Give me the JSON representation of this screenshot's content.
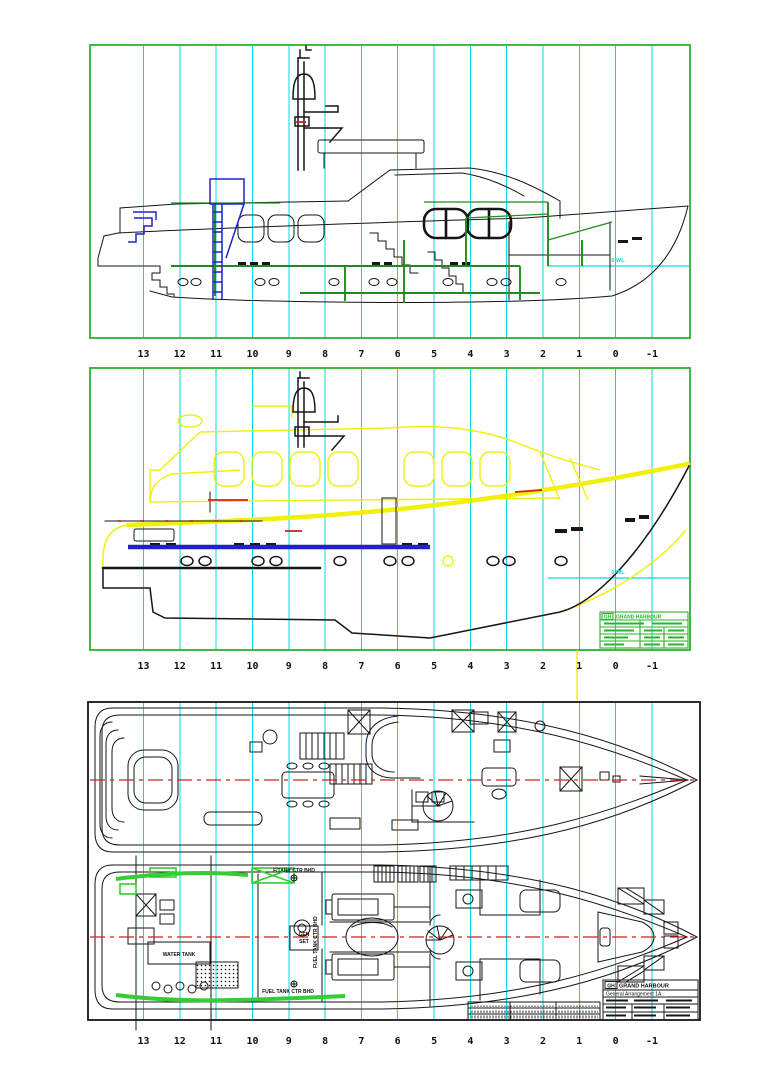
{
  "colors": {
    "grid_cyan": "#00dcdc",
    "frame_green": "#28b428",
    "structure_green": "#1e8c1e",
    "highlight_green": "#35cc35",
    "accent_blue": "#2020cc",
    "hull_yellow": "#f0f00a",
    "centerline_red": "#cc2222",
    "linework_black": "#161616"
  },
  "stations": {
    "labels": [
      "13",
      "12",
      "11",
      "10",
      "9",
      "8",
      "7",
      "6",
      "5",
      "4",
      "3",
      "2",
      "1",
      "0",
      "-1"
    ]
  },
  "views": {
    "structural_profile": {
      "waterline_label": "0.WL"
    },
    "lines_profile": {
      "waterline_label": "0.WL",
      "title_block": {
        "logo": "GH",
        "company": "GRAND HARBOUR"
      }
    },
    "deck_plans": {
      "labels": {
        "fwd_tank_bulkhead": "F/TANK CTR BHD",
        "fuel_tank_bulkhead": "FUEL TANK   CTR BHD",
        "fuel_tank_bulkhead_vertical": "FUEL TANK CTR BHD",
        "gen_line1": "GEN",
        "gen_line2": "SET",
        "water_tank": "WATER TANK"
      },
      "title_block": {
        "logo": "GH",
        "company": "GRAND HARBOUR",
        "drawing_title": "General Arrangement 1A"
      }
    }
  }
}
